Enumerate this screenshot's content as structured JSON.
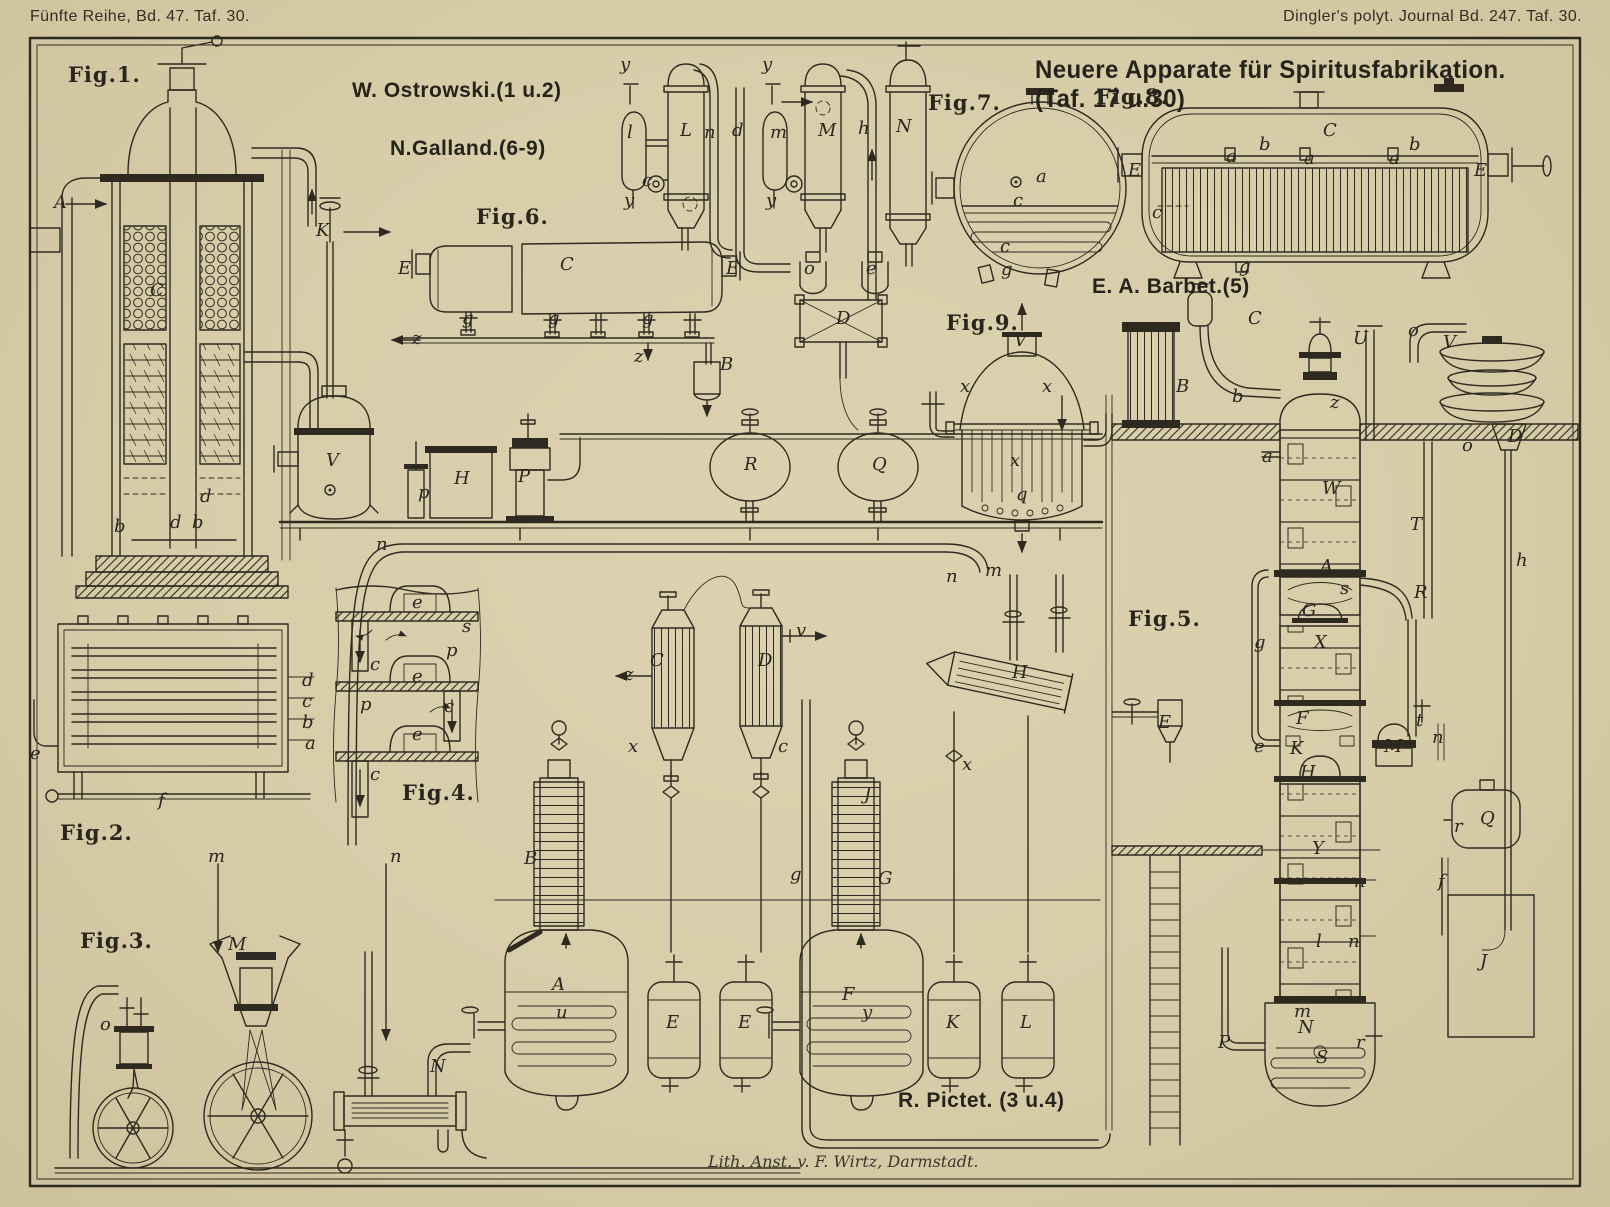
{
  "plate": {
    "header_left": "Fünfte Reihe, Bd. 47. Taf. 30.",
    "header_right": "Dingler's polyt. Journal Bd. 247. Taf. 30.",
    "title": "Neuere Apparate für Spiritusfabrikation. (Taf. 17 u.30)",
    "imprint": "Lith. Anst. v. F. Wirtz, Darmstadt.",
    "colors": {
      "paper": "#d7cda9",
      "ink": "#2e2a20"
    }
  },
  "attributions": [
    {
      "text": "W. Ostrowski.(1 u.2)",
      "x": 352,
      "y": 80
    },
    {
      "text": "N.Galland.(6-9)",
      "x": 390,
      "y": 138
    },
    {
      "text": "E. A. Barbet.(5)",
      "x": 1092,
      "y": 276
    },
    {
      "text": "R. Pictet. (3 u.4)",
      "x": 898,
      "y": 1090
    }
  ],
  "figure_labels": [
    {
      "label": "Fig.1.",
      "x": 68,
      "y": 64
    },
    {
      "label": "Fig.2.",
      "x": 60,
      "y": 822
    },
    {
      "label": "Fig.3.",
      "x": 80,
      "y": 930
    },
    {
      "label": "Fig.4.",
      "x": 402,
      "y": 782
    },
    {
      "label": "Fig.5.",
      "x": 1128,
      "y": 608
    },
    {
      "label": "Fig.6.",
      "x": 476,
      "y": 206
    },
    {
      "label": "Fig.7.",
      "x": 928,
      "y": 92
    },
    {
      "label": "Fig.8.",
      "x": 1096,
      "y": 86
    },
    {
      "label": "Fig.9.",
      "x": 946,
      "y": 312
    }
  ],
  "part_labels": [
    {
      "t": "A",
      "x": 54,
      "y": 194
    },
    {
      "t": "C",
      "x": 150,
      "y": 282
    },
    {
      "t": "b",
      "x": 114,
      "y": 518
    },
    {
      "t": "d",
      "x": 200,
      "y": 488
    },
    {
      "t": "d",
      "x": 170,
      "y": 514
    },
    {
      "t": "b",
      "x": 192,
      "y": 514
    },
    {
      "t": "d",
      "x": 302,
      "y": 672
    },
    {
      "t": "c",
      "x": 302,
      "y": 693
    },
    {
      "t": "b",
      "x": 302,
      "y": 714
    },
    {
      "t": "a",
      "x": 305,
      "y": 735
    },
    {
      "t": "e",
      "x": 30,
      "y": 745
    },
    {
      "t": "f",
      "x": 158,
      "y": 792
    },
    {
      "t": "m",
      "x": 208,
      "y": 848
    },
    {
      "t": "n",
      "x": 390,
      "y": 848
    },
    {
      "t": "M",
      "x": 228,
      "y": 936
    },
    {
      "t": "o",
      "x": 100,
      "y": 1016
    },
    {
      "t": "N",
      "x": 430,
      "y": 1058
    },
    {
      "t": "e",
      "x": 412,
      "y": 594
    },
    {
      "t": "s",
      "x": 462,
      "y": 618
    },
    {
      "t": "p",
      "x": 446,
      "y": 642
    },
    {
      "t": "c",
      "x": 370,
      "y": 656
    },
    {
      "t": "e",
      "x": 412,
      "y": 668
    },
    {
      "t": "p",
      "x": 360,
      "y": 696
    },
    {
      "t": "c",
      "x": 444,
      "y": 698
    },
    {
      "t": "e",
      "x": 412,
      "y": 726
    },
    {
      "t": "c",
      "x": 370,
      "y": 766
    },
    {
      "t": "K",
      "x": 316,
      "y": 222
    },
    {
      "t": "E",
      "x": 398,
      "y": 260
    },
    {
      "t": "C",
      "x": 560,
      "y": 256
    },
    {
      "t": "g",
      "x": 462,
      "y": 310
    },
    {
      "t": "g",
      "x": 548,
      "y": 310
    },
    {
      "t": "g",
      "x": 642,
      "y": 310
    },
    {
      "t": "z",
      "x": 412,
      "y": 330
    },
    {
      "t": "z",
      "x": 634,
      "y": 348
    },
    {
      "t": "E",
      "x": 726,
      "y": 260
    },
    {
      "t": "B",
      "x": 720,
      "y": 356
    },
    {
      "t": "y",
      "x": 620,
      "y": 56
    },
    {
      "t": "l",
      "x": 627,
      "y": 124
    },
    {
      "t": "L",
      "x": 680,
      "y": 122
    },
    {
      "t": "n",
      "x": 704,
      "y": 124
    },
    {
      "t": "d",
      "x": 732,
      "y": 122
    },
    {
      "t": "y",
      "x": 624,
      "y": 192
    },
    {
      "t": "c",
      "x": 642,
      "y": 172
    },
    {
      "t": "y",
      "x": 762,
      "y": 56
    },
    {
      "t": "m",
      "x": 770,
      "y": 124
    },
    {
      "t": "M",
      "x": 818,
      "y": 122
    },
    {
      "t": "h",
      "x": 858,
      "y": 120
    },
    {
      "t": "N",
      "x": 896,
      "y": 118
    },
    {
      "t": "y",
      "x": 766,
      "y": 192
    },
    {
      "t": "o",
      "x": 804,
      "y": 260
    },
    {
      "t": "e",
      "x": 866,
      "y": 260
    },
    {
      "t": "D",
      "x": 836,
      "y": 310
    },
    {
      "t": "V",
      "x": 326,
      "y": 452
    },
    {
      "t": "H",
      "x": 454,
      "y": 470
    },
    {
      "t": "P",
      "x": 518,
      "y": 468
    },
    {
      "t": "p",
      "x": 418,
      "y": 484
    },
    {
      "t": "R",
      "x": 744,
      "y": 456
    },
    {
      "t": "Q",
      "x": 872,
      "y": 456
    },
    {
      "t": "a",
      "x": 1036,
      "y": 168
    },
    {
      "t": "c",
      "x": 1013,
      "y": 192
    },
    {
      "t": "c",
      "x": 1000,
      "y": 238
    },
    {
      "t": "g",
      "x": 1001,
      "y": 261
    },
    {
      "t": "E",
      "x": 1128,
      "y": 162
    },
    {
      "t": "a",
      "x": 1226,
      "y": 148
    },
    {
      "t": "b",
      "x": 1259,
      "y": 136
    },
    {
      "t": "C",
      "x": 1323,
      "y": 122
    },
    {
      "t": "a",
      "x": 1304,
      "y": 150
    },
    {
      "t": "a",
      "x": 1389,
      "y": 150
    },
    {
      "t": "b",
      "x": 1409,
      "y": 136
    },
    {
      "t": "E",
      "x": 1474,
      "y": 162
    },
    {
      "t": "c",
      "x": 1152,
      "y": 204
    },
    {
      "t": "g",
      "x": 1239,
      "y": 258
    },
    {
      "t": "V",
      "x": 1014,
      "y": 332
    },
    {
      "t": "x",
      "x": 960,
      "y": 378
    },
    {
      "t": "x",
      "x": 1042,
      "y": 378
    },
    {
      "t": "x",
      "x": 1010,
      "y": 452
    },
    {
      "t": "q",
      "x": 1016,
      "y": 486
    },
    {
      "t": "C",
      "x": 1248,
      "y": 310
    },
    {
      "t": "b",
      "x": 1232,
      "y": 388
    },
    {
      "t": "B",
      "x": 1176,
      "y": 378
    },
    {
      "t": "U",
      "x": 1353,
      "y": 330
    },
    {
      "t": "o",
      "x": 1408,
      "y": 322
    },
    {
      "t": "V",
      "x": 1443,
      "y": 334
    },
    {
      "t": "D",
      "x": 1508,
      "y": 428
    },
    {
      "t": "o",
      "x": 1462,
      "y": 437
    },
    {
      "t": "z",
      "x": 1330,
      "y": 394
    },
    {
      "t": "a",
      "x": 1262,
      "y": 448
    },
    {
      "t": "W",
      "x": 1322,
      "y": 480
    },
    {
      "t": "T",
      "x": 1410,
      "y": 516
    },
    {
      "t": "A",
      "x": 1320,
      "y": 558
    },
    {
      "t": "R",
      "x": 1414,
      "y": 584
    },
    {
      "t": "s",
      "x": 1340,
      "y": 580
    },
    {
      "t": "G",
      "x": 1302,
      "y": 602
    },
    {
      "t": "X",
      "x": 1314,
      "y": 634
    },
    {
      "t": "g",
      "x": 1254,
      "y": 634
    },
    {
      "t": "h",
      "x": 1516,
      "y": 552
    },
    {
      "t": "E",
      "x": 1158,
      "y": 714
    },
    {
      "t": "e",
      "x": 1254,
      "y": 738
    },
    {
      "t": "K",
      "x": 1290,
      "y": 740
    },
    {
      "t": "F",
      "x": 1296,
      "y": 710
    },
    {
      "t": "H",
      "x": 1300,
      "y": 764
    },
    {
      "t": "M",
      "x": 1384,
      "y": 738
    },
    {
      "t": "t",
      "x": 1416,
      "y": 712
    },
    {
      "t": "n",
      "x": 1432,
      "y": 729
    },
    {
      "t": "Q",
      "x": 1480,
      "y": 810
    },
    {
      "t": "r",
      "x": 1454,
      "y": 818
    },
    {
      "t": "Y",
      "x": 1312,
      "y": 840
    },
    {
      "t": "n",
      "x": 1354,
      "y": 873
    },
    {
      "t": "f",
      "x": 1438,
      "y": 873
    },
    {
      "t": "l",
      "x": 1316,
      "y": 933
    },
    {
      "t": "n",
      "x": 1348,
      "y": 933
    },
    {
      "t": "m",
      "x": 1294,
      "y": 1003
    },
    {
      "t": "N",
      "x": 1298,
      "y": 1019
    },
    {
      "t": "S",
      "x": 1316,
      "y": 1049
    },
    {
      "t": "P",
      "x": 1218,
      "y": 1034
    },
    {
      "t": "r",
      "x": 1356,
      "y": 1034
    },
    {
      "t": "J",
      "x": 1480,
      "y": 953
    },
    {
      "t": "n",
      "x": 376,
      "y": 536
    },
    {
      "t": "m",
      "x": 985,
      "y": 562
    },
    {
      "t": "n",
      "x": 946,
      "y": 568
    },
    {
      "t": "C",
      "x": 650,
      "y": 652
    },
    {
      "t": "D",
      "x": 758,
      "y": 652
    },
    {
      "t": "z",
      "x": 624,
      "y": 666
    },
    {
      "t": "v",
      "x": 796,
      "y": 622
    },
    {
      "t": "x",
      "x": 628,
      "y": 738
    },
    {
      "t": "c",
      "x": 778,
      "y": 738
    },
    {
      "t": "H",
      "x": 1012,
      "y": 664
    },
    {
      "t": "B",
      "x": 524,
      "y": 850
    },
    {
      "t": "g",
      "x": 790,
      "y": 866
    },
    {
      "t": "G",
      "x": 878,
      "y": 870
    },
    {
      "t": "x",
      "x": 962,
      "y": 756
    },
    {
      "t": "J",
      "x": 864,
      "y": 786
    },
    {
      "t": "A",
      "x": 552,
      "y": 976
    },
    {
      "t": "u",
      "x": 556,
      "y": 1004
    },
    {
      "t": "E",
      "x": 666,
      "y": 1014
    },
    {
      "t": "E",
      "x": 738,
      "y": 1014
    },
    {
      "t": "F",
      "x": 842,
      "y": 986
    },
    {
      "t": "y",
      "x": 862,
      "y": 1004
    },
    {
      "t": "K",
      "x": 946,
      "y": 1014
    },
    {
      "t": "L",
      "x": 1020,
      "y": 1014
    }
  ]
}
